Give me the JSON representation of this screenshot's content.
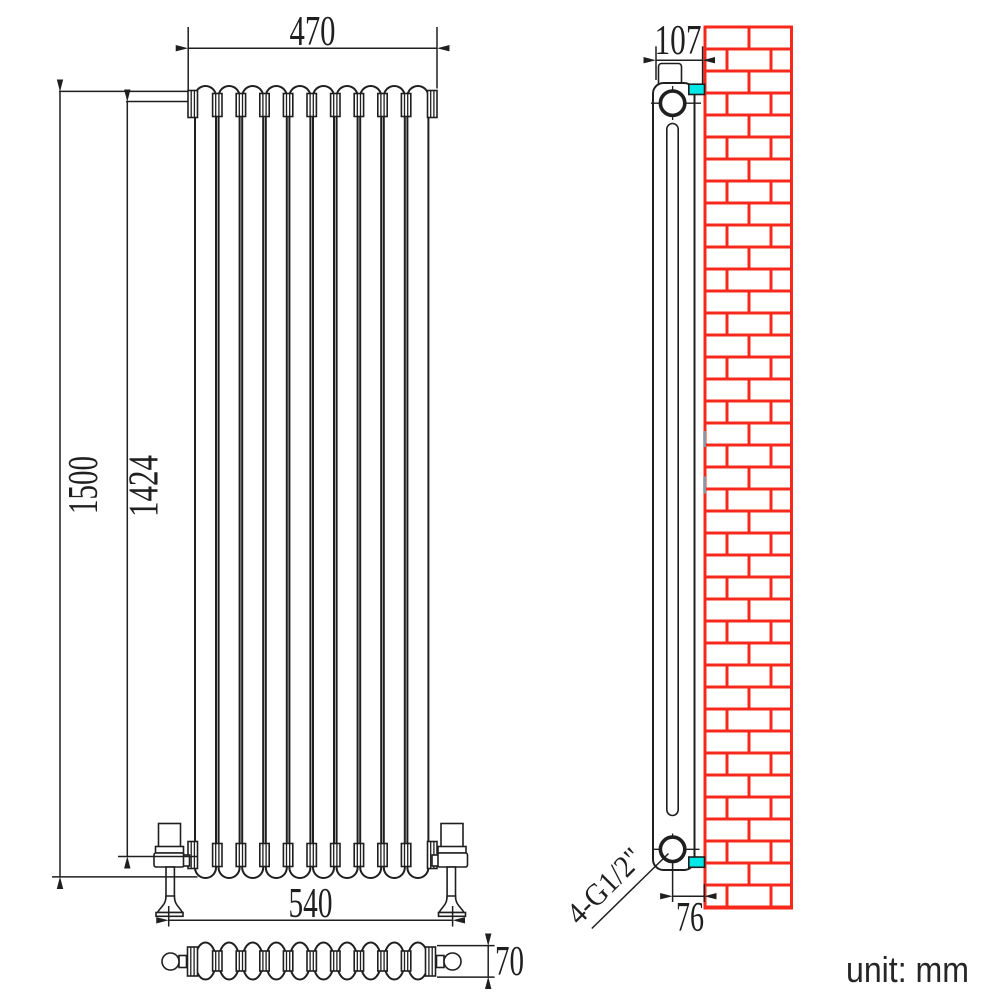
{
  "drawing": {
    "kind": "radiator installation technical drawing",
    "views": {
      "front": {
        "column_count": 10
      },
      "plan": {
        "section_count": 10
      },
      "side": {
        "has_wall": true,
        "bracket_count": 2
      }
    }
  },
  "dimensions": {
    "front_top_width": "470",
    "front_overall_height": "1500",
    "front_tapping_height": "1424",
    "front_valve_centres": "540",
    "plan_depth": "70",
    "side_overall_depth": "107",
    "side_wall_to_pipe_centre": "76",
    "side_thread_spec": "4-G1/2\""
  },
  "notes": {
    "unit": "unit: mm"
  },
  "colors": {
    "line": "#1f1f1f",
    "wall_brick": "#f9281c",
    "bracket_highlight": "#00e7e7",
    "background": "#ffffff"
  }
}
